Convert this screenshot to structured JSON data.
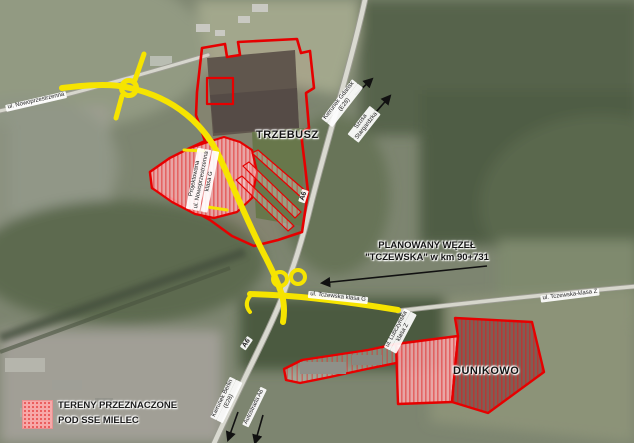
{
  "map": {
    "place_labels": {
      "trzebusz": "TRZEBUSZ",
      "dunikowo": "DUNIKOWO"
    },
    "annotation": {
      "line1": "PLANOWANY WĘZEŁ",
      "line2": "\"TCZEWSKA\" w km 90+731"
    },
    "legend": {
      "line1": "TERENY PRZEZNACZONE",
      "line2": "POD SSE MIELEC"
    },
    "roads": {
      "nowoprzestrzenna": "ul. Nowoprzestrzenna",
      "projektowana_l1": "Projektowana",
      "projektowana_l2": "ul. Nowoprzestrzenna",
      "projektowana_l3": "klasa G",
      "tczewska_g": "ul. Tczewska klasa G",
      "tczewska_z": "ul. Tczewska-klasa Z",
      "a6_upper": "A6",
      "a6_lower": "A6",
      "lubczynska_l1": "ul. Lubczyńska",
      "lubczynska_l2": "klasa Z",
      "dir_ne_1_l1": "Kierunek Gdańsk",
      "dir_ne_1_l2": "(E28)",
      "dir_ne_2_l1": "Szosa",
      "dir_ne_2_l2": "Stargardzka",
      "dir_sw_1_l1": "Kierunek Berlin",
      "dir_sw_1_l2": "(E28)",
      "dir_sw_2": "Autostrada A6"
    },
    "colors": {
      "planned_road_yellow": "#f6e400",
      "zone_outline_red": "#e60000",
      "zone_fill_pink": "#f5a9ac",
      "arrow_black": "#111111",
      "legend_swatch_pink": "#f7a8a8"
    }
  }
}
